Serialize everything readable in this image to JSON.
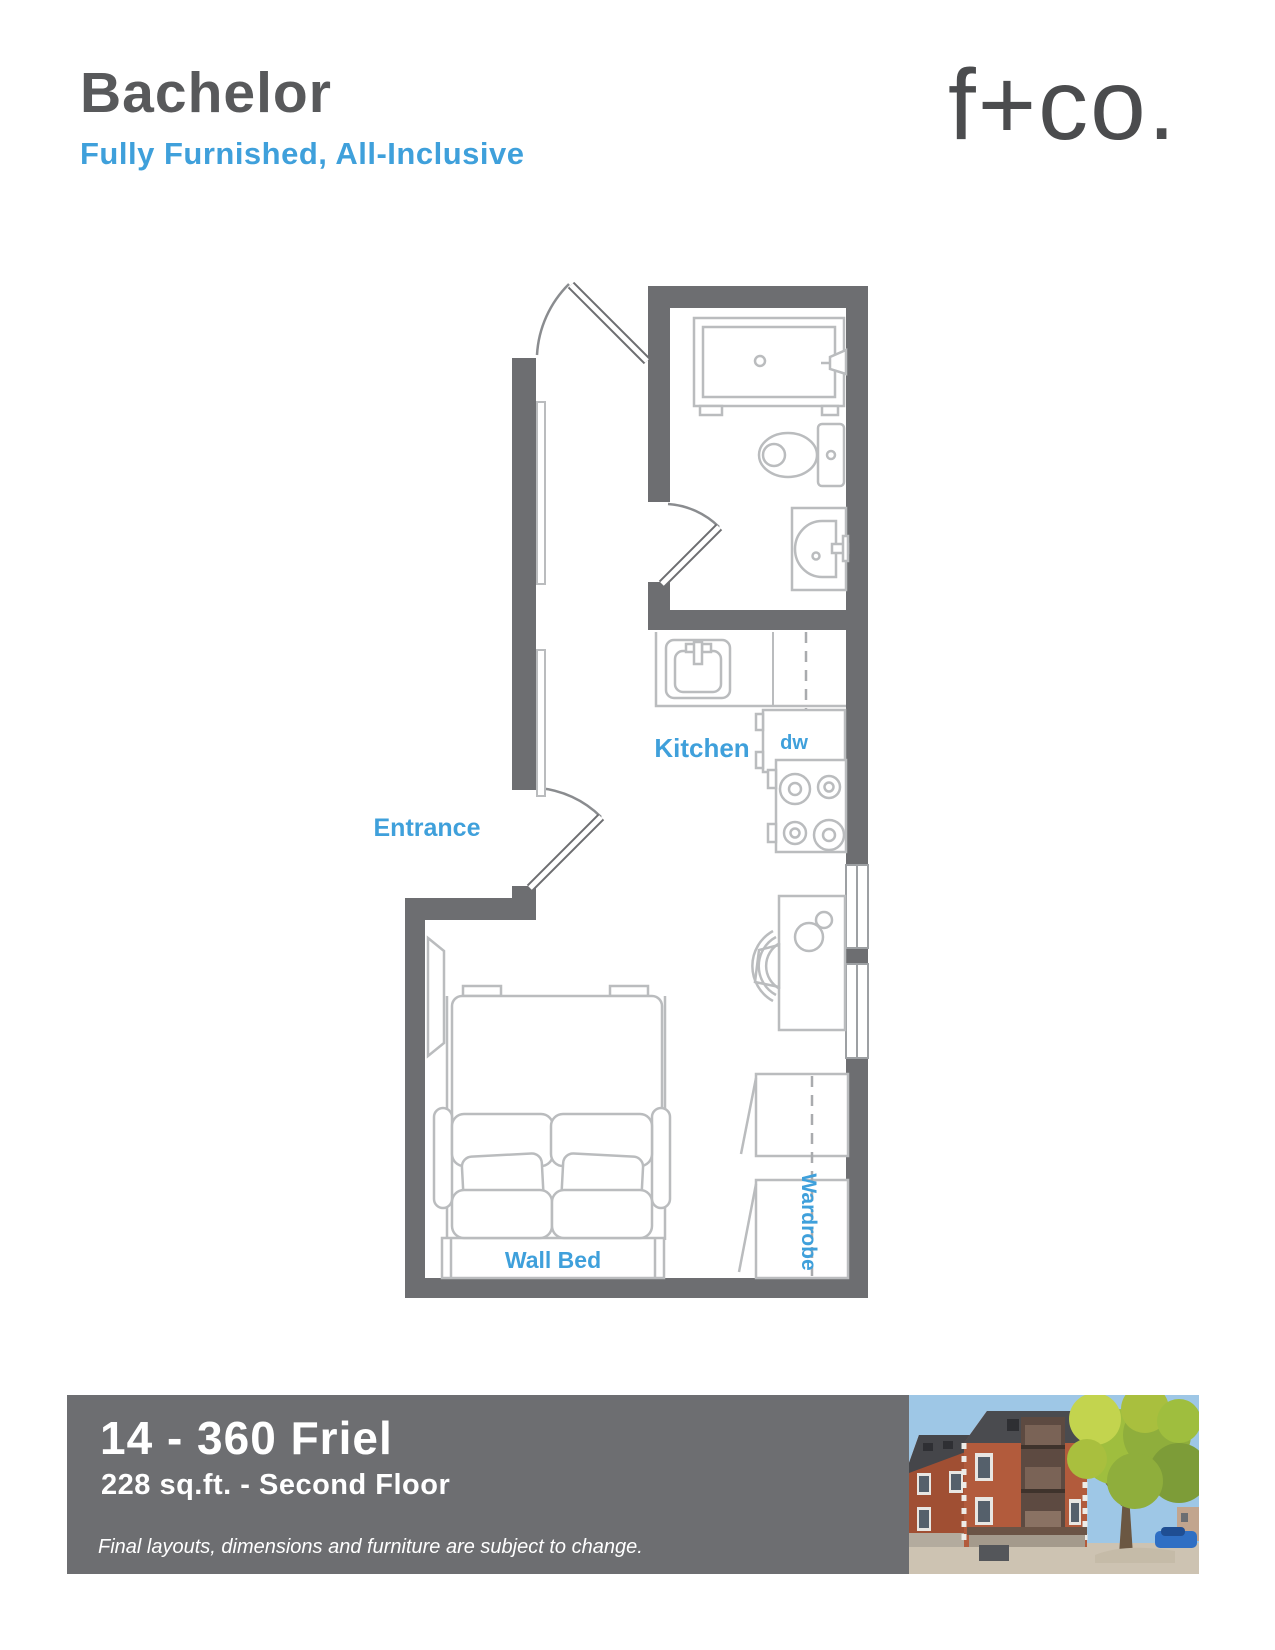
{
  "header": {
    "title": "Bachelor",
    "subtitle": "Fully Furnished, All-Inclusive",
    "brand_logo": "f+co."
  },
  "floor_plan": {
    "labels": {
      "entrance": "Entrance",
      "kitchen": "Kitchen",
      "dishwasher": "dw",
      "wall_bed": "Wall Bed",
      "wardrobe": "Wardrobe"
    }
  },
  "footer": {
    "unit_title": "14 - 360 Friel",
    "unit_details": "228 sq.ft. - Second Floor",
    "disclaimer": "Final layouts, dimensions and furniture are subject to change."
  },
  "colors": {
    "accent_blue": "#3FA0DB",
    "wall_gray": "#6D6E71",
    "heading_gray": "#58595B",
    "fixture_gray": "#BABCBE",
    "footer_bar_gray": "#6D6E71"
  }
}
